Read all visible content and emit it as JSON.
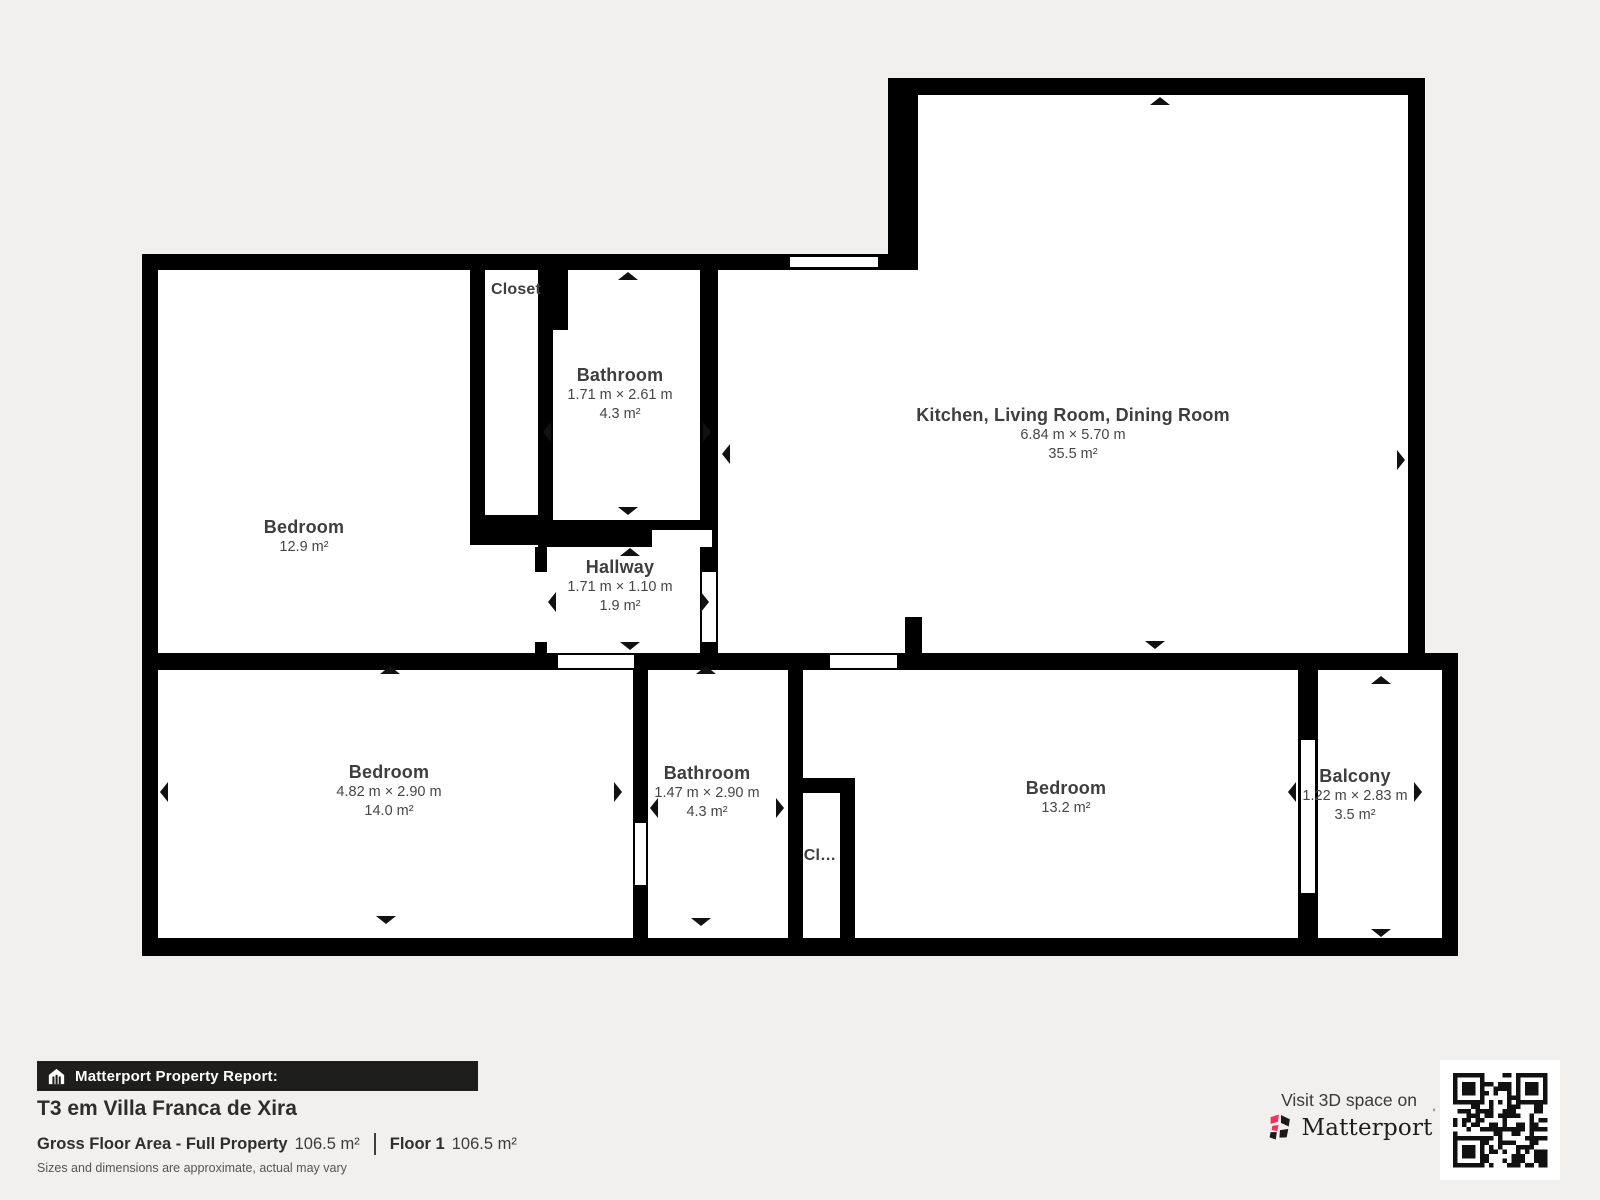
{
  "plan": {
    "wall_color": "#000000",
    "room_fill": "#ffffff",
    "background": "#f1f0ee",
    "label_color": "#3e3e3e",
    "rooms": [
      {
        "name": "Bedroom",
        "area": "12.9 m²"
      },
      {
        "name": "Closet"
      },
      {
        "name": "Bathroom",
        "dims": "1.71 m × 2.61 m",
        "area": "4.3 m²"
      },
      {
        "name": "Hallway",
        "dims": "1.71 m × 1.10 m",
        "area": "1.9 m²"
      },
      {
        "name": "Kitchen, Living Room, Dining Room",
        "dims": "6.84 m × 5.70 m",
        "area": "35.5 m²"
      },
      {
        "name": "Bedroom",
        "dims": "4.82 m × 2.90 m",
        "area": "14.0 m²"
      },
      {
        "name": "Bathroom",
        "dims": "1.47 m × 2.90 m",
        "area": "4.3 m²"
      },
      {
        "name": "Cl…"
      },
      {
        "name": "Bedroom",
        "area": "13.2 m²"
      },
      {
        "name": "Balcony",
        "dims": "1.22 m × 2.83 m",
        "area": "3.5 m²"
      }
    ]
  },
  "footer": {
    "report_label": "Matterport Property Report:",
    "property_title": "T3 em Villa Franca de Xira",
    "gross_floor_area_label": "Gross Floor Area - Full Property",
    "gross_floor_area_value": "106.5 m²",
    "floor_label": "Floor 1",
    "floor_value": "106.5 m²",
    "disclaimer": "Sizes and dimensions are approximate, actual may vary",
    "visit_text": "Visit 3D space on",
    "brand": "Matterport",
    "brand_mark": "'",
    "accent_color": "#f5325c",
    "bar_color": "#1e1e1d"
  }
}
